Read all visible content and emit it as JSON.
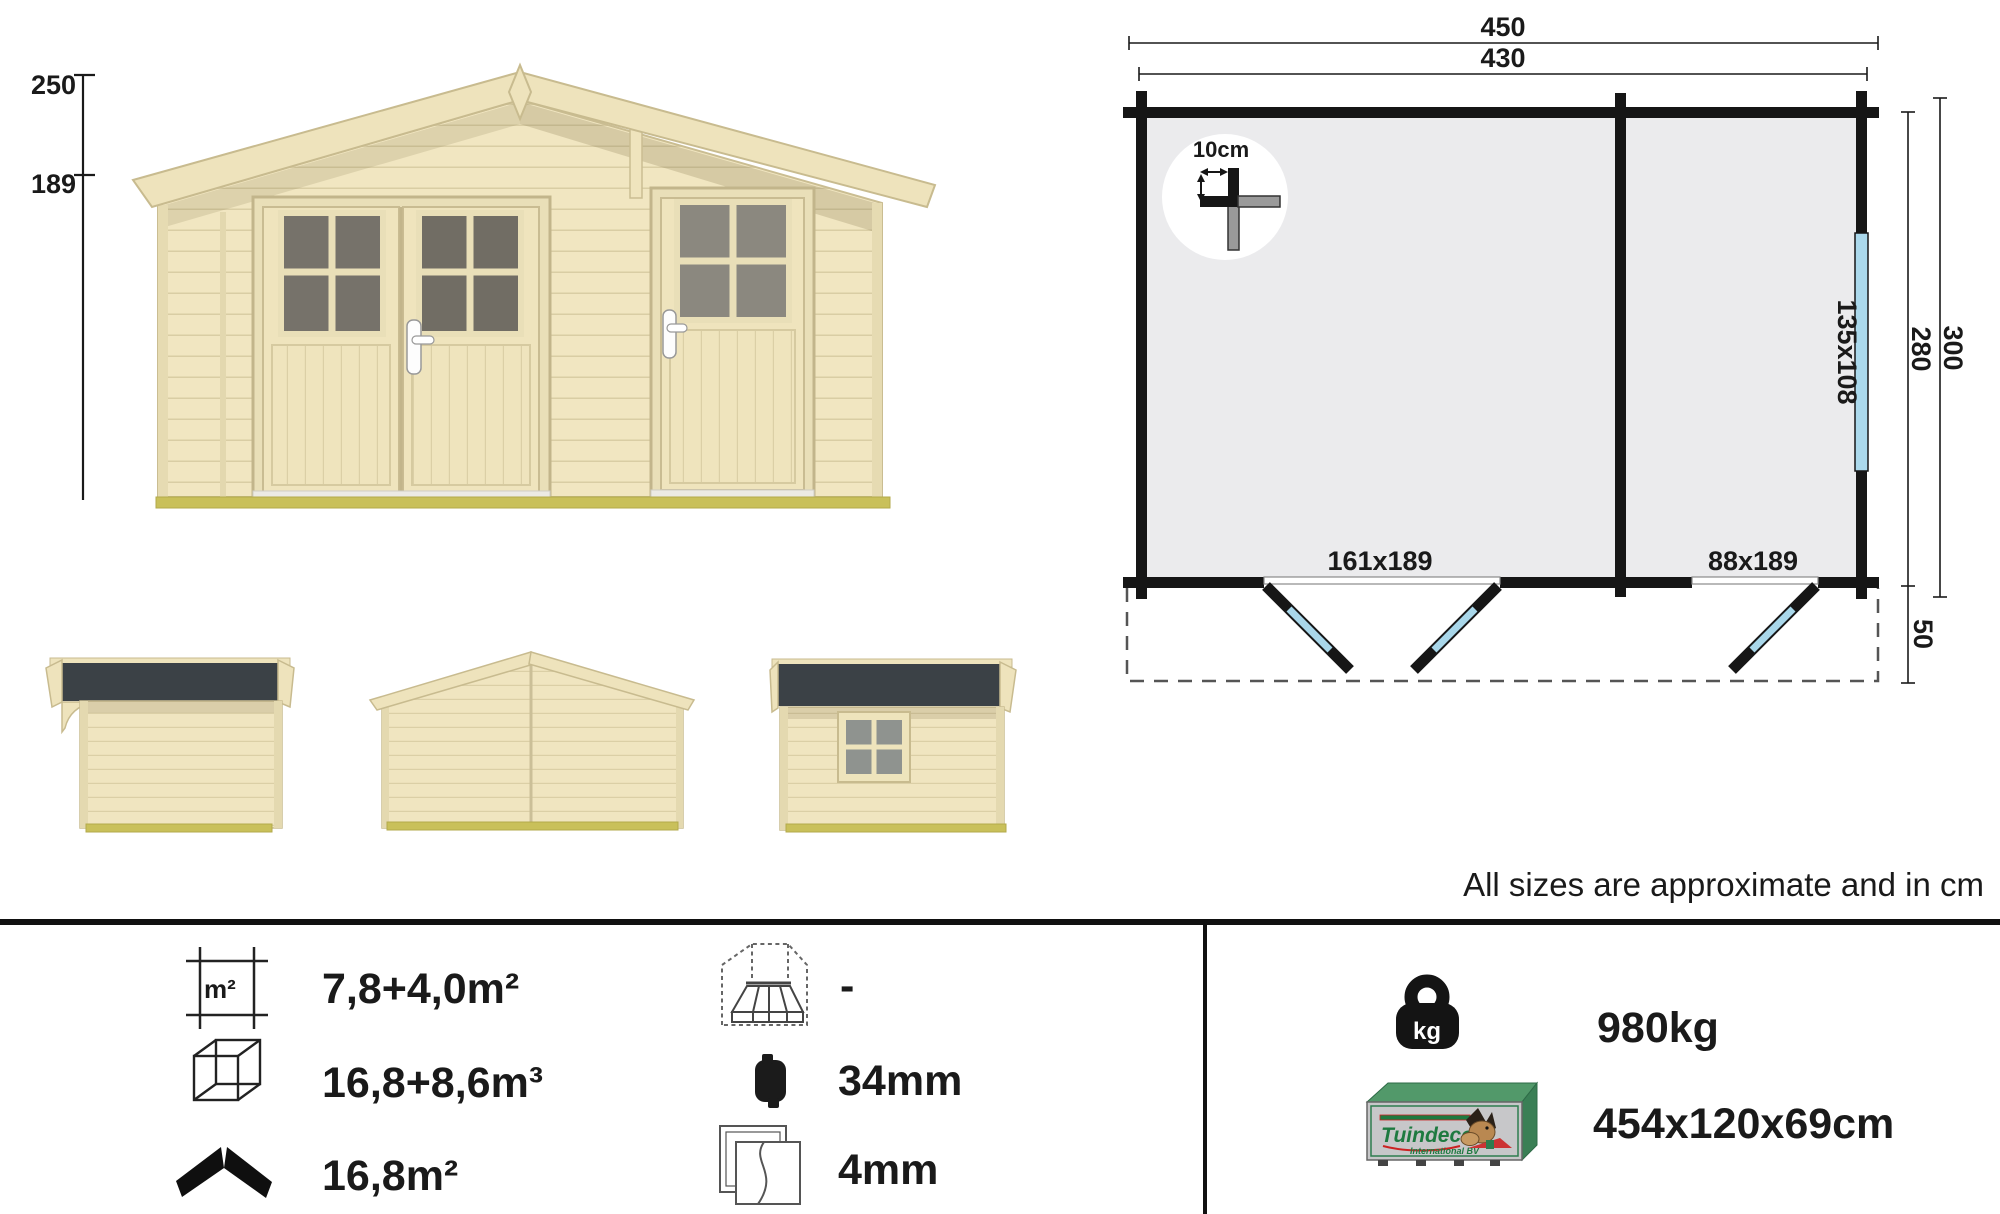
{
  "sheet": {
    "note": "All sizes are approximate and in cm"
  },
  "front_elevation": {
    "dim_peak_height": "250",
    "dim_wall_height": "189"
  },
  "floor_plan": {
    "dim_total_width": "450",
    "dim_wall_width": "430",
    "dim_total_depth": "300",
    "dim_wall_depth": "280",
    "dim_canopy_depth": "50",
    "window_size": "135x108",
    "double_door_size": "161x189",
    "single_door_size": "88x189",
    "log_detail": "10cm"
  },
  "specs": {
    "floor_area": "7,8+4,0m²",
    "volume": "16,8+8,6m³",
    "roof_area": "16,8m²",
    "canopy_area": "-",
    "wall_thickness": "34mm",
    "glazing_thickness": "4mm",
    "weight": "980kg",
    "package_dimensions": "454x120x69cm",
    "floor_icon_label": "m²",
    "weight_icon_label": "kg"
  },
  "brand": {
    "name": "Tuindeco",
    "subtitle": "International BV"
  },
  "colors": {
    "wood": "#f1e6c1",
    "wood_line": "#d9cda4",
    "roof_dark": "#3b4146",
    "glass_dark": "#76726a",
    "glass_light": "#8b887f",
    "foundation_olive": "#c9c05a",
    "plan_fill": "#ebebed",
    "plan_wall": "#161616",
    "window_blue": "#abd9ec",
    "swing_blue": "#a9d7ea",
    "brand_green": "#2e7d4f",
    "box_silver": "#c7c7c9"
  }
}
